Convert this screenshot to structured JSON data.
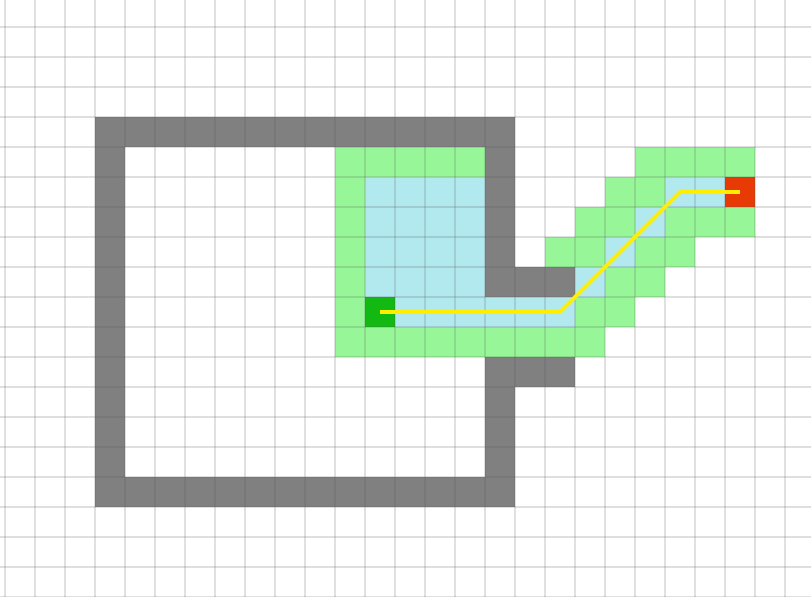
{
  "grid": {
    "canvas_width": 811,
    "canvas_height": 597,
    "cell_size": 30,
    "origin_x": 5,
    "origin_y": -3,
    "columns": 27,
    "rows": 20,
    "background_color": "#ffffff",
    "line_color": "#555555",
    "line_opacity": 0.3,
    "line_width": 1.2
  },
  "cells": {
    "wall_color": "#808080",
    "frontier_color": "#97f697",
    "explored_color": "#b2e9ee",
    "start_color": "#12b912",
    "goal_color": "#e83a05",
    "walls": [
      [
        3,
        4
      ],
      [
        4,
        4
      ],
      [
        5,
        4
      ],
      [
        6,
        4
      ],
      [
        7,
        4
      ],
      [
        8,
        4
      ],
      [
        9,
        4
      ],
      [
        10,
        4
      ],
      [
        11,
        4
      ],
      [
        12,
        4
      ],
      [
        13,
        4
      ],
      [
        14,
        4
      ],
      [
        15,
        4
      ],
      [
        16,
        4
      ],
      [
        3,
        5
      ],
      [
        3,
        6
      ],
      [
        3,
        7
      ],
      [
        3,
        8
      ],
      [
        3,
        9
      ],
      [
        3,
        10
      ],
      [
        3,
        11
      ],
      [
        3,
        12
      ],
      [
        3,
        13
      ],
      [
        3,
        14
      ],
      [
        3,
        15
      ],
      [
        3,
        16
      ],
      [
        4,
        16
      ],
      [
        5,
        16
      ],
      [
        6,
        16
      ],
      [
        7,
        16
      ],
      [
        8,
        16
      ],
      [
        9,
        16
      ],
      [
        10,
        16
      ],
      [
        11,
        16
      ],
      [
        12,
        16
      ],
      [
        13,
        16
      ],
      [
        14,
        16
      ],
      [
        15,
        16
      ],
      [
        16,
        16
      ],
      [
        16,
        5
      ],
      [
        16,
        6
      ],
      [
        16,
        7
      ],
      [
        16,
        8
      ],
      [
        16,
        9
      ],
      [
        16,
        12
      ],
      [
        16,
        13
      ],
      [
        16,
        14
      ],
      [
        16,
        15
      ],
      [
        17,
        9
      ],
      [
        18,
        9
      ],
      [
        17,
        12
      ],
      [
        18,
        12
      ]
    ],
    "frontier": [
      [
        11,
        5
      ],
      [
        12,
        5
      ],
      [
        13,
        5
      ],
      [
        14,
        5
      ],
      [
        15,
        5
      ],
      [
        21,
        5
      ],
      [
        22,
        5
      ],
      [
        23,
        5
      ],
      [
        24,
        5
      ],
      [
        11,
        6
      ],
      [
        20,
        6
      ],
      [
        21,
        6
      ],
      [
        11,
        7
      ],
      [
        19,
        7
      ],
      [
        20,
        7
      ],
      [
        22,
        7
      ],
      [
        23,
        7
      ],
      [
        24,
        7
      ],
      [
        11,
        8
      ],
      [
        18,
        8
      ],
      [
        19,
        8
      ],
      [
        21,
        8
      ],
      [
        22,
        8
      ],
      [
        11,
        9
      ],
      [
        20,
        9
      ],
      [
        21,
        9
      ],
      [
        11,
        10
      ],
      [
        19,
        10
      ],
      [
        20,
        10
      ],
      [
        11,
        11
      ],
      [
        12,
        11
      ],
      [
        13,
        11
      ],
      [
        14,
        11
      ],
      [
        15,
        11
      ],
      [
        16,
        11
      ],
      [
        17,
        11
      ],
      [
        18,
        11
      ],
      [
        19,
        11
      ]
    ],
    "explored": [
      [
        12,
        6
      ],
      [
        13,
        6
      ],
      [
        14,
        6
      ],
      [
        15,
        6
      ],
      [
        22,
        6
      ],
      [
        23,
        6
      ],
      [
        12,
        7
      ],
      [
        13,
        7
      ],
      [
        14,
        7
      ],
      [
        15,
        7
      ],
      [
        21,
        7
      ],
      [
        12,
        8
      ],
      [
        13,
        8
      ],
      [
        14,
        8
      ],
      [
        15,
        8
      ],
      [
        20,
        8
      ],
      [
        12,
        9
      ],
      [
        13,
        9
      ],
      [
        14,
        9
      ],
      [
        15,
        9
      ],
      [
        19,
        9
      ],
      [
        13,
        10
      ],
      [
        14,
        10
      ],
      [
        15,
        10
      ],
      [
        16,
        10
      ],
      [
        17,
        10
      ],
      [
        18,
        10
      ]
    ],
    "start": [
      12,
      10
    ],
    "goal": [
      24,
      6
    ]
  },
  "path": {
    "color": "#ffee00",
    "width": 4,
    "cells": [
      [
        12,
        10
      ],
      [
        18,
        10
      ],
      [
        22,
        6
      ],
      [
        24,
        6
      ]
    ]
  }
}
